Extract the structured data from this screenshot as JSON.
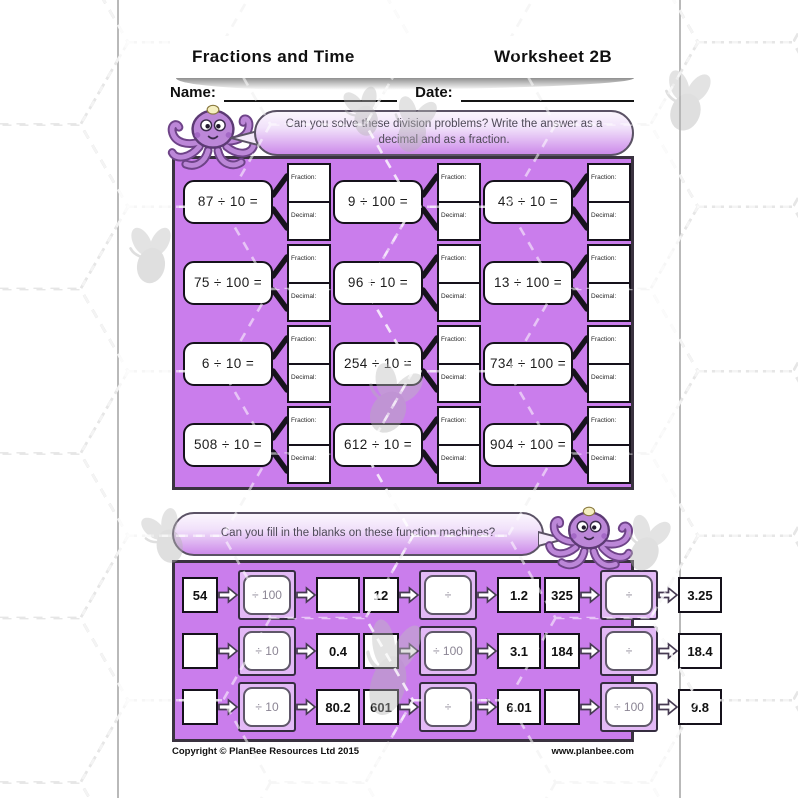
{
  "header": {
    "title": "Fractions and Time",
    "worksheet": "Worksheet 2B"
  },
  "fields": {
    "name": "Name:",
    "date": "Date:"
  },
  "bubbles": {
    "division_prompt": "Can you solve these division problems? Write the answer as a decimal and as a fraction.",
    "machines_prompt": "Can you fill in the blanks on these function machines?"
  },
  "division": {
    "fraction_label": "Fraction:",
    "decimal_label": "Decimal:",
    "problems": [
      "87 ÷ 10 =",
      "9 ÷ 100 =",
      "43 ÷ 10 =",
      "75 ÷ 100 =",
      "96 ÷ 10 =",
      "13 ÷ 100 =",
      "6 ÷ 10 =",
      "254 ÷ 10 =",
      "734 ÷ 100 =",
      "508 ÷ 10 =",
      "612 ÷ 10 =",
      "904 ÷ 100 ="
    ]
  },
  "machines": [
    {
      "input": "54",
      "op": "÷ 100",
      "output": ""
    },
    {
      "input": "12",
      "op": "÷",
      "output": "1.2"
    },
    {
      "input": "325",
      "op": "÷",
      "output": "3.25"
    },
    {
      "input": "",
      "op": "÷ 10",
      "output": "0.4"
    },
    {
      "input": "",
      "op": "÷ 100",
      "output": "3.1"
    },
    {
      "input": "184",
      "op": "÷",
      "output": "18.4"
    },
    {
      "input": "",
      "op": "÷ 10",
      "output": "80.2"
    },
    {
      "input": "601",
      "op": "÷",
      "output": "6.01"
    },
    {
      "input": "",
      "op": "÷ 100",
      "output": "9.8"
    }
  ],
  "footer": {
    "copyright": "Copyright © PlanBee Resources Ltd 2015",
    "website": "www.planbee.com"
  },
  "colors": {
    "panel_purple": "#ca7dec",
    "machine_fill": "#e3b9f6",
    "bubble_bottom": "#cd8bea",
    "bubble_top": "#fbf6fd",
    "border_dark": "#3a3240"
  }
}
